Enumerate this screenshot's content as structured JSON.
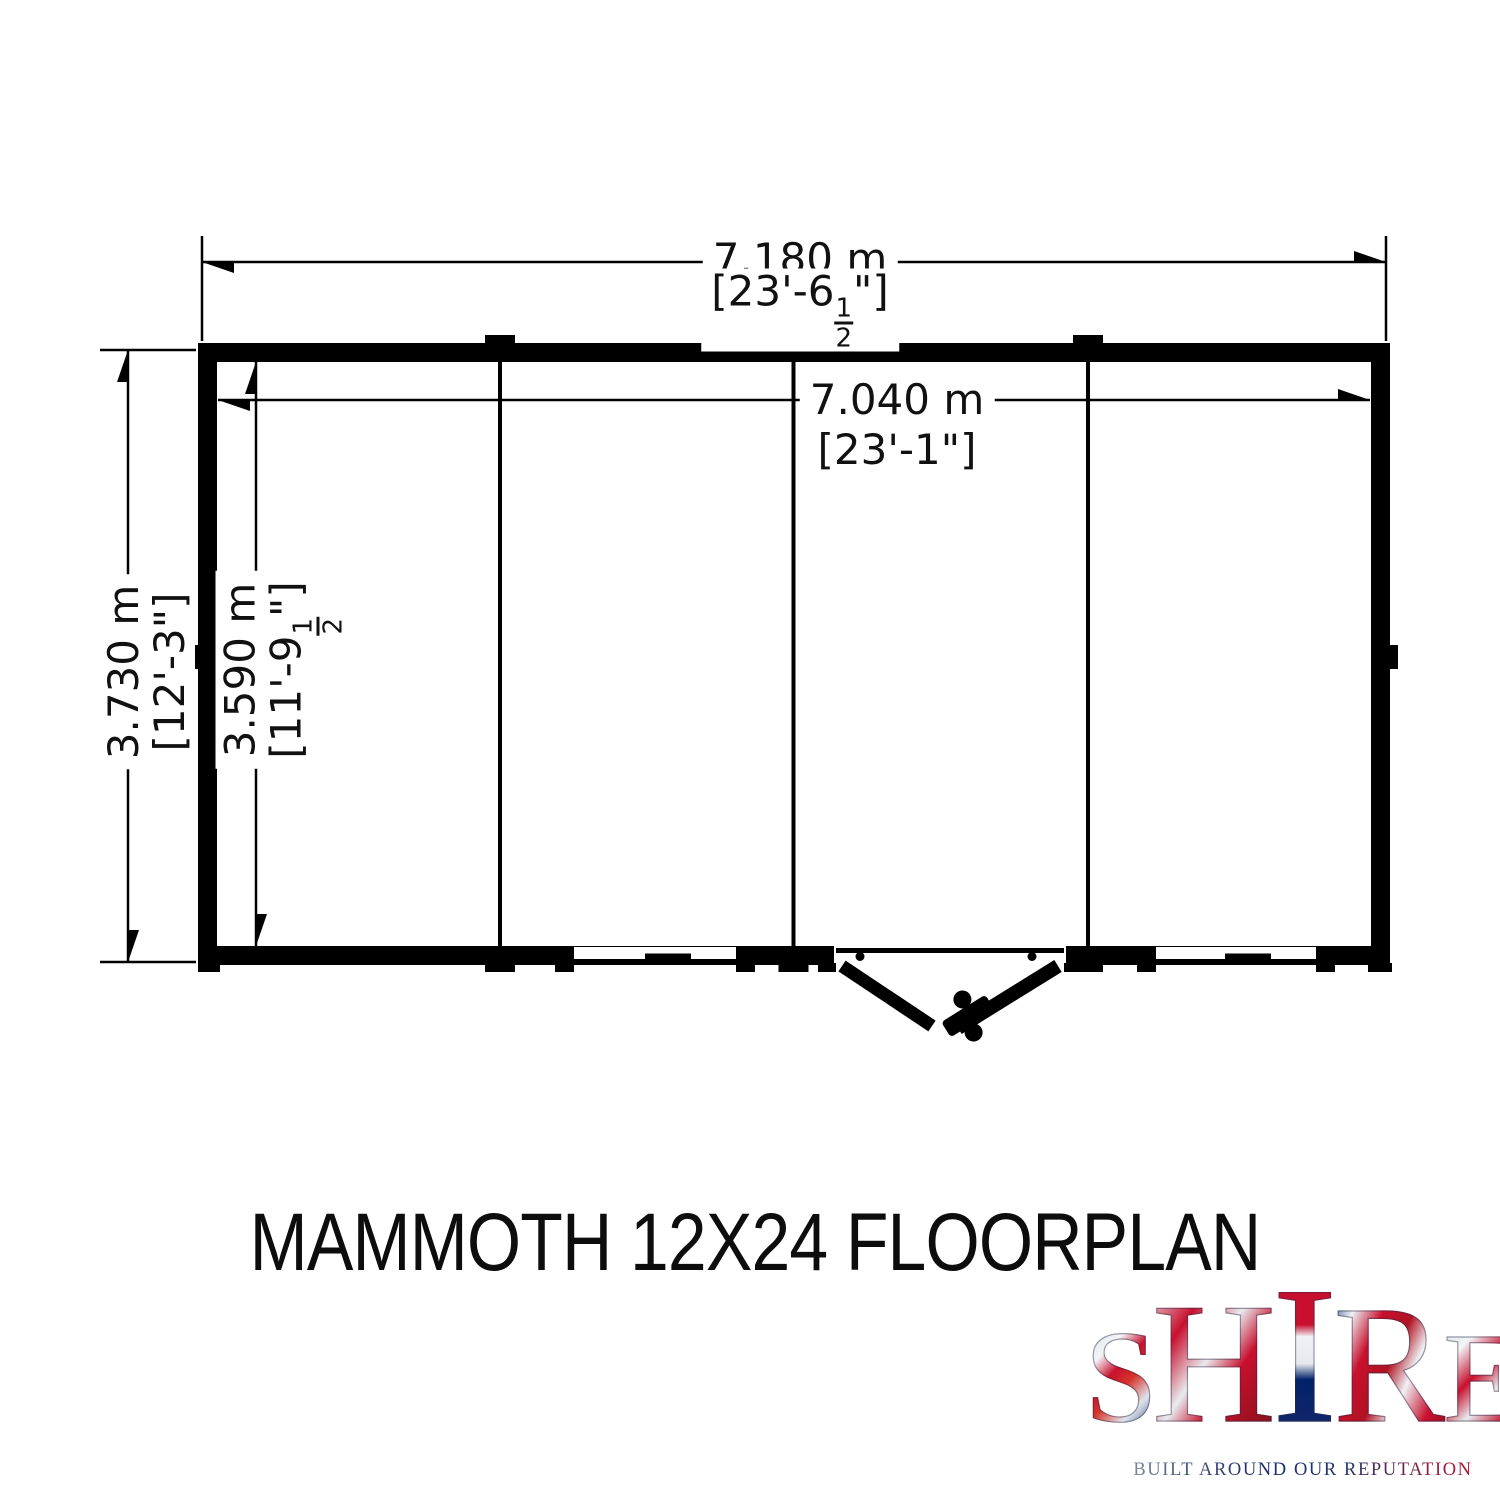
{
  "floorplan": {
    "title": "MAMMOTH 12X24 FLOORPLAN",
    "dimensions": {
      "outer_width": {
        "metric": "7.180 m",
        "imperial_pre": "[23'-6",
        "frac_num": "1",
        "frac_den": "2",
        "imperial_post": "\"]"
      },
      "inner_width": {
        "metric": "7.040 m",
        "imperial": "[23'-1\"]"
      },
      "outer_depth": {
        "metric": "3.730 m",
        "imperial": "[12'-3\"]"
      },
      "inner_depth": {
        "metric": "3.590 m",
        "imperial_pre": "[11'-9",
        "frac_num": "1",
        "frac_den": "2",
        "imperial_post": "\"]"
      }
    },
    "features": {
      "panel_joints": 3,
      "windows": 2,
      "door_type": "double outward-opening doors, front wall"
    },
    "line_color": "#000000",
    "background_color": "#ffffff"
  },
  "logo": {
    "brand": "SHIRE",
    "letters": [
      "S",
      "H",
      "I",
      "R",
      "E"
    ],
    "tagline": "BUILT AROUND OUR REPUTATION",
    "colors": {
      "red": "#c8102e",
      "blue": "#012169",
      "silver": "#d8dee6"
    }
  }
}
